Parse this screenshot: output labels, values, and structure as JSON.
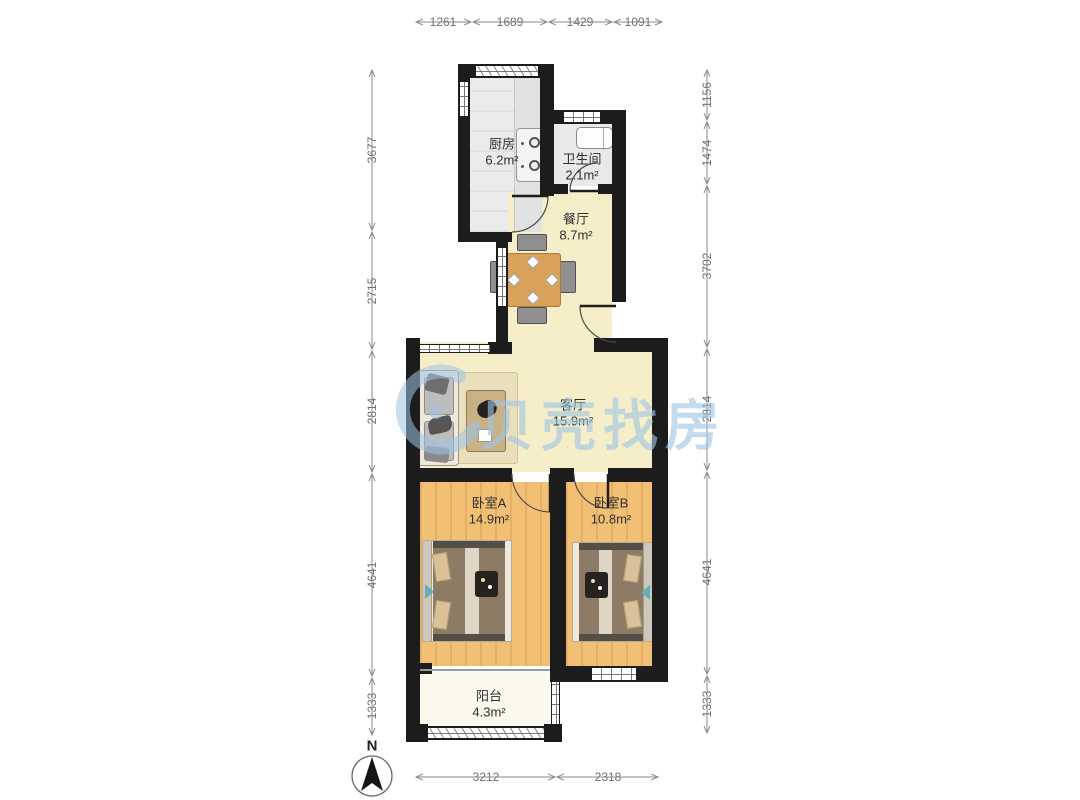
{
  "watermark": {
    "text": "贝壳找房",
    "color": "#9ec5e5"
  },
  "compass": {
    "label": "N"
  },
  "rooms": [
    {
      "name": "厨房",
      "area": "6.2m²"
    },
    {
      "name": "卫生间",
      "area": "2.1m²"
    },
    {
      "name": "餐厅",
      "area": "8.7m²"
    },
    {
      "name": "客厅",
      "area": "15.9m²"
    },
    {
      "name": "卧室A",
      "area": "14.9m²"
    },
    {
      "name": "卧室B",
      "area": "10.8m²"
    },
    {
      "name": "阳台",
      "area": "4.3m²"
    }
  ],
  "dimensions": {
    "top": [
      "1261",
      "1689",
      "1429",
      "1091"
    ],
    "bottom": [
      "3212",
      "2318"
    ],
    "left": [
      "3677",
      "2715",
      "2814",
      "4641",
      "1333"
    ],
    "right": [
      "1156",
      "1474",
      "3702",
      "2814",
      "4641",
      "1333"
    ]
  }
}
